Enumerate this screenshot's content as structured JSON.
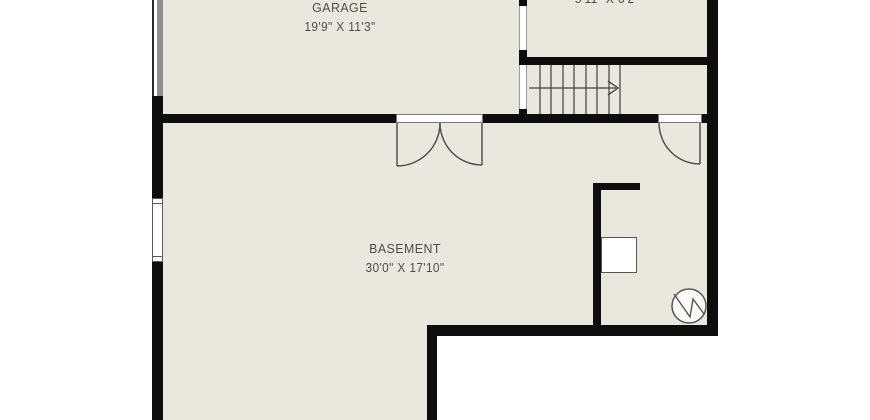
{
  "colors": {
    "floor": "#e9e7de",
    "wall": "#0d0d0d",
    "outside": "#ffffff",
    "thin_line": "#4a4a4a",
    "garage_door": "#8f8f8f",
    "text": "#4e4e4c"
  },
  "rooms": {
    "garage": {
      "name": "GARAGE",
      "dims": "19'9\" X 11'3\""
    },
    "top_right": {
      "dims": "5'11\" X 6'2\""
    },
    "basement": {
      "name": "BASEMENT",
      "dims": "30'0\" X 17'10\""
    }
  },
  "fixtures": {
    "stairs": {
      "direction": "right",
      "treads": 8
    },
    "water_heater": "water-heater",
    "appliance": "furnace-box",
    "garage_door": "garage-door",
    "window": "window",
    "double_door": "double-swing-door",
    "single_door": "single-swing-door"
  }
}
